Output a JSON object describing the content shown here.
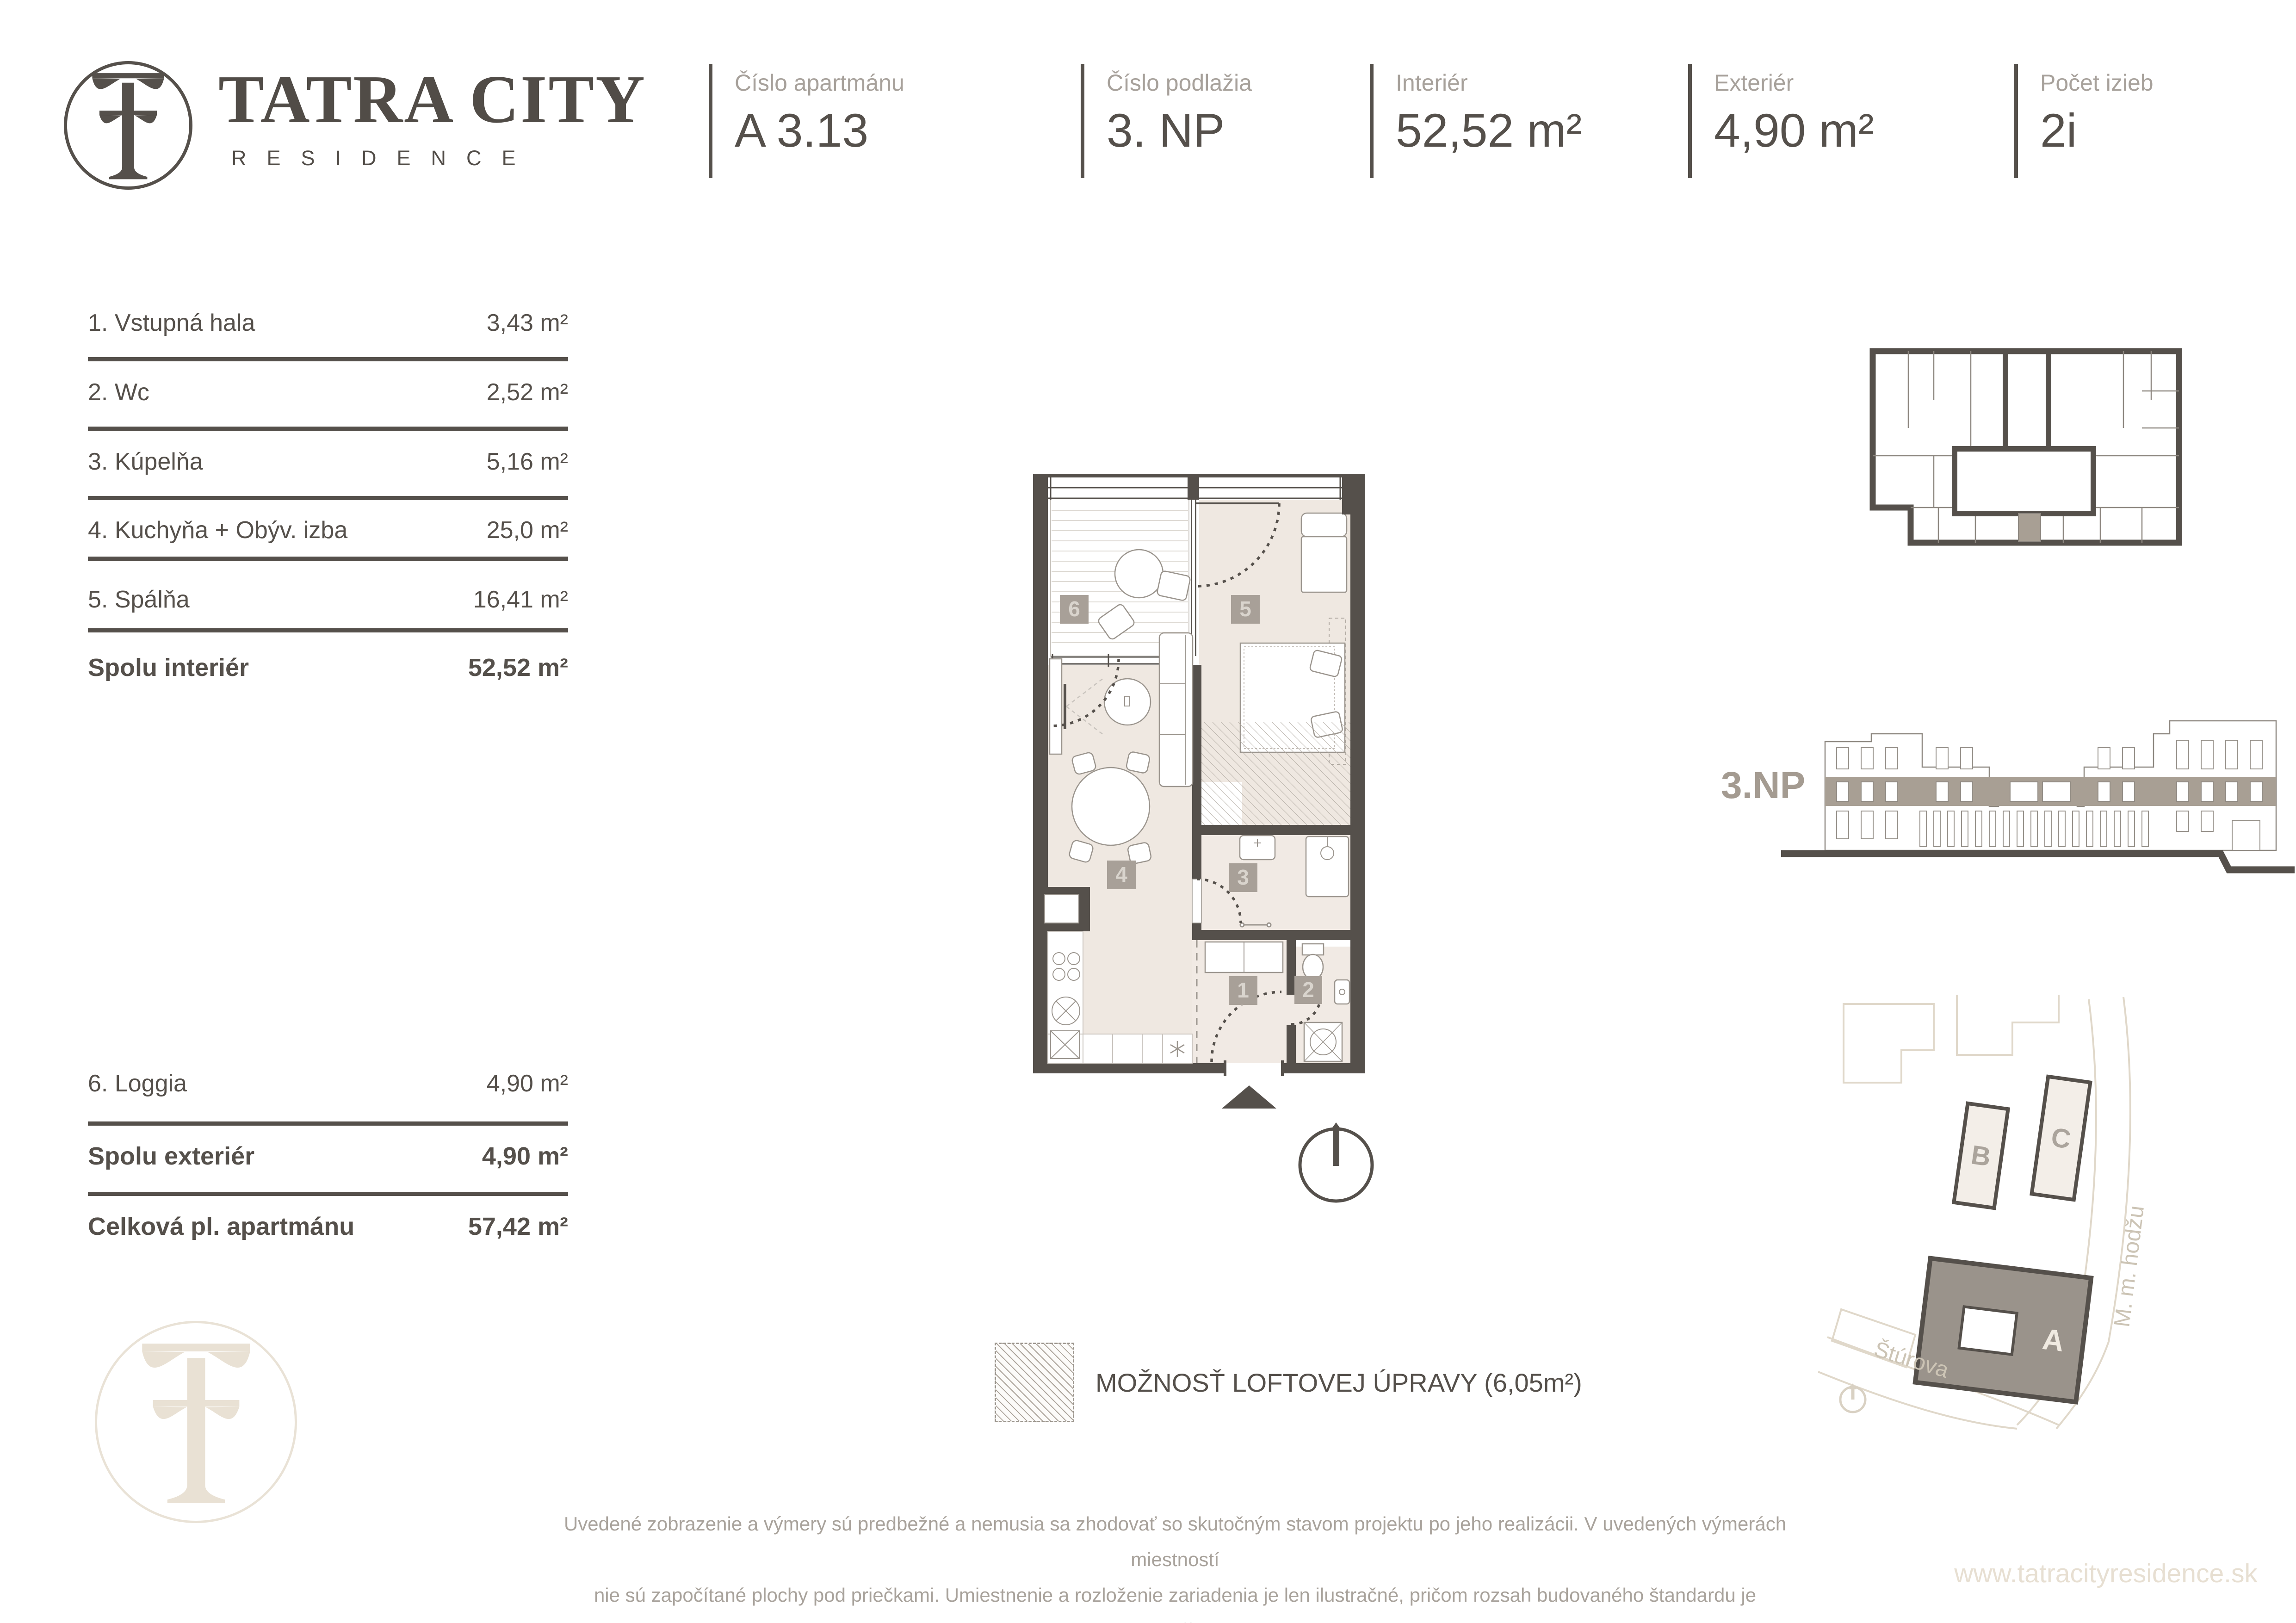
{
  "header": {
    "brand_title": "TATRA CITY",
    "brand_subtitle": "RESIDENCE",
    "fields": [
      {
        "label": "Číslo apartmánu",
        "value": "A 3.13"
      },
      {
        "label": "Číslo podlažia",
        "value": "3. NP"
      },
      {
        "label": "Interiér",
        "value": "52,52 m²"
      },
      {
        "label": "Exteriér",
        "value": "4,90 m²"
      },
      {
        "label": "Počet izieb",
        "value": "2i"
      }
    ]
  },
  "room_table": {
    "interior_rows": [
      {
        "name": "1. Vstupná hala",
        "area": "3,43 m²"
      },
      {
        "name": "2. Wc",
        "area": "2,52 m²"
      },
      {
        "name": "3. Kúpelňa",
        "area": "5,16 m²"
      },
      {
        "name": "4. Kuchyňa + Obýv. izba",
        "area": "25,0 m²"
      },
      {
        "name": "5. Spálňa",
        "area": "16,41 m²"
      }
    ],
    "interior_total": {
      "name": "Spolu interiér",
      "area": "52,52 m²"
    },
    "exterior_rows": [
      {
        "name": "6. Loggia",
        "area": "4,90 m²"
      }
    ],
    "exterior_total": {
      "name": "Spolu exteriér",
      "area": "4,90 m²"
    },
    "grand_total": {
      "name": "Celková pl. apartmánu",
      "area": "57,42 m²"
    }
  },
  "floor_plan": {
    "room_numbers": [
      "1",
      "2",
      "3",
      "4",
      "5",
      "6"
    ]
  },
  "elevation": {
    "floor_label": "3.NP"
  },
  "site_plan": {
    "building_a": "A",
    "building_b": "B",
    "building_c": "C",
    "street_bottom": "Štúrova",
    "street_right": "M. m. hodžu"
  },
  "legend": {
    "loft_label": "MOŽNOSŤ LOFTOVEJ ÚPRAVY (6,05m²)"
  },
  "disclaimer": {
    "line1": "Uvedené zobrazenie a výmery sú predbežné a nemusia sa zhodovať so skutočným stavom projektu po jeho realizácii. V uvedených výmerách miestností",
    "line2": "nie sú započítané plochy pod priečkami. Umiestnenie a rozloženie zariadenia je len ilustračné, pričom rozsah budovaného štandardu je",
    "line3": "popísaný v technickej špecifikácii projektu."
  },
  "footer": {
    "website": "www.tatracityresidence.sk"
  },
  "colors": {
    "dark": "#55504B",
    "label_gray": "#A7A19B",
    "floor_beige": "#EFE8E1",
    "badge_taupe": "#A8A098",
    "highlight_taupe": "#A89F94",
    "site_building_a": "#9A938B",
    "watermark_beige": "#E9E1D4"
  }
}
